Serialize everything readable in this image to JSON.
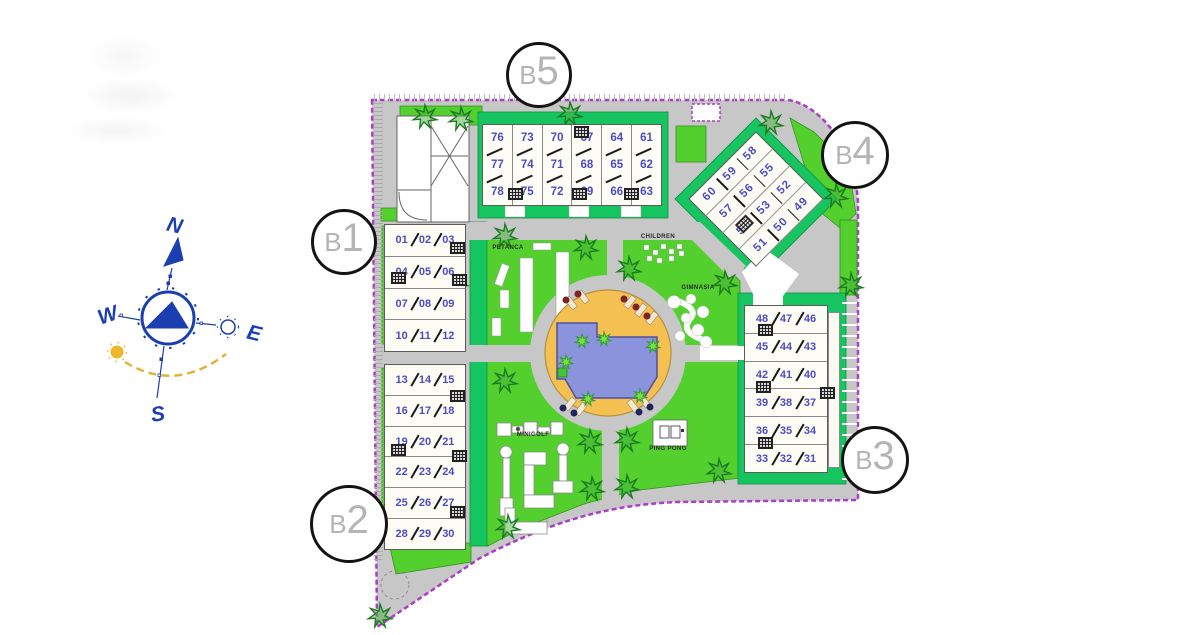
{
  "compass": {
    "north": "N",
    "south": "S",
    "east": "E",
    "west": "W"
  },
  "block_markers": {
    "b1": {
      "letter": "B",
      "number": "1"
    },
    "b2": {
      "letter": "B",
      "number": "2"
    },
    "b3": {
      "letter": "B",
      "number": "3"
    },
    "b4": {
      "letter": "B",
      "number": "4"
    },
    "b5": {
      "letter": "B",
      "number": "5"
    }
  },
  "amenity_labels": {
    "petanca": "PETANCA",
    "children": "CHILDREN",
    "gymnasium": "GIMNASIA",
    "minigolf": "MINIGOLF",
    "ping_pong": "PING PONG"
  },
  "buildings": {
    "b5": {
      "columns": [
        [
          "76",
          "77",
          "78"
        ],
        [
          "73",
          "74",
          "75"
        ],
        [
          "70",
          "71",
          "72"
        ],
        [
          "67",
          "68",
          "69"
        ],
        [
          "64",
          "65",
          "66"
        ],
        [
          "61",
          "62",
          "63"
        ]
      ]
    },
    "b1": {
      "rows": [
        [
          "01",
          "02",
          "03"
        ],
        [
          "04",
          "05",
          "06"
        ],
        [
          "07",
          "08",
          "09"
        ],
        [
          "10",
          "11",
          "12"
        ]
      ]
    },
    "b2": {
      "rows": [
        [
          "13",
          "14",
          "15"
        ],
        [
          "16",
          "17",
          "18"
        ],
        [
          "19",
          "20",
          "21"
        ],
        [
          "22",
          "23",
          "24"
        ],
        [
          "25",
          "26",
          "27"
        ],
        [
          "28",
          "29",
          "30"
        ]
      ]
    },
    "b3": {
      "rows": [
        [
          "48",
          "47",
          "46"
        ],
        [
          "45",
          "44",
          "43"
        ],
        [
          "42",
          "41",
          "40"
        ],
        [
          "39",
          "38",
          "37"
        ],
        [
          "36",
          "35",
          "34"
        ],
        [
          "33",
          "32",
          "31"
        ]
      ]
    },
    "b4": {
      "rows": [
        [
          "60",
          "59",
          "58"
        ],
        [
          "57",
          "56",
          "55"
        ],
        [
          "54",
          "53",
          "52"
        ],
        [
          "51",
          "50",
          "49"
        ]
      ]
    }
  },
  "colors": {
    "road": "#c7c7c7",
    "lawn": "#53d02e",
    "emerald": "#16c55f",
    "boundary": "#a93fc4",
    "pool_deck": "#f3c051",
    "pool_water": "#8a93db",
    "unit_number": "#4b4bc8",
    "tree_outline": "#1b7a22",
    "compass_blue": "#1b3fb0",
    "sun_yellow": "#eeb629"
  }
}
